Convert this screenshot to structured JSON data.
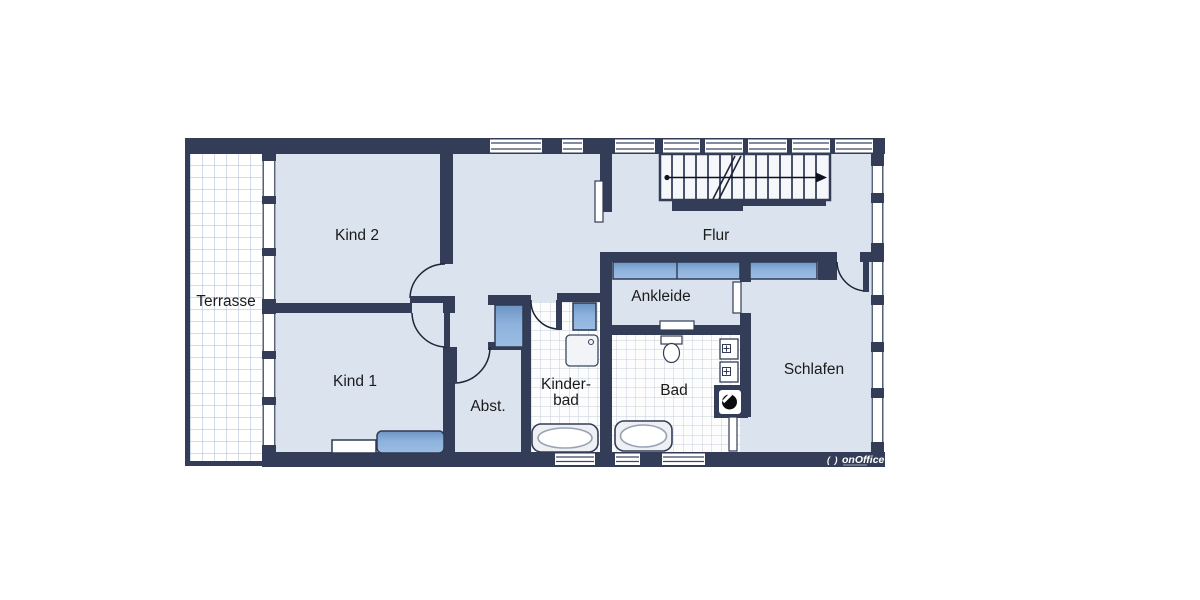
{
  "plan": {
    "rooms": {
      "terrasse": {
        "label": "Terrasse"
      },
      "kind2": {
        "label": "Kind 2"
      },
      "kind1": {
        "label": "Kind 1"
      },
      "flur": {
        "label": "Flur"
      },
      "ankleide": {
        "label": "Ankleide"
      },
      "abstellraum": {
        "label": "Abst."
      },
      "kinderbad": {
        "label_line1": "Kinder-",
        "label_line2": "bad"
      },
      "bad": {
        "label": "Bad"
      },
      "schlafen": {
        "label": "Schlafen"
      }
    },
    "branding": {
      "logo_mark": "( )",
      "logo_text": "onOffice"
    },
    "colors": {
      "wall": "#333d57",
      "room_fill": "#dbe3ee",
      "furniture_blue": "#8db2dc",
      "furniture_blue_dark": "#6d94c4",
      "tile_grid": "#c5cdda",
      "terrace_grid": "#a8b9d3",
      "label_text": "#1b1b1b",
      "logo_text": "#ffffff"
    }
  }
}
